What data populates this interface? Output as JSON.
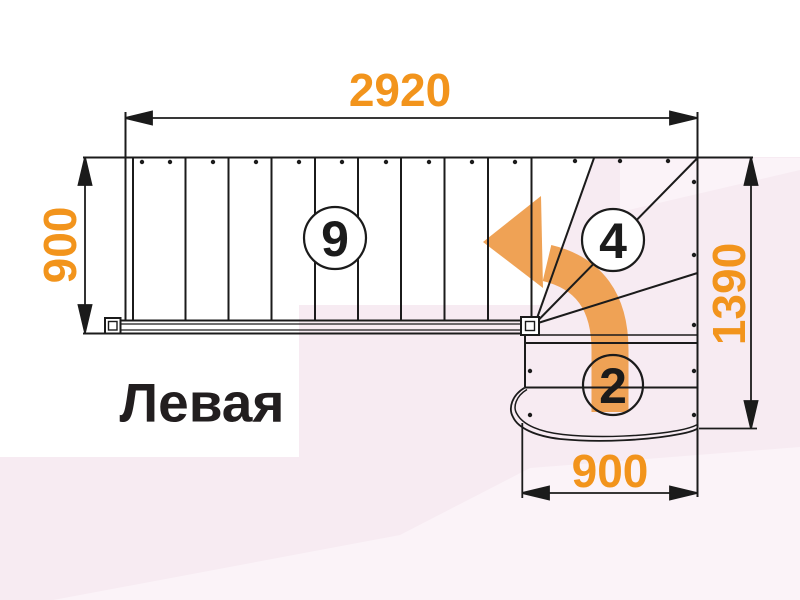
{
  "diagram": {
    "title": "Левая",
    "dimensions": {
      "top": "2920",
      "left": "900",
      "right": "1390",
      "bottom": "900"
    },
    "step_counts": {
      "upper_flight": "9",
      "winder": "4",
      "lower_flight": "2"
    }
  },
  "colors": {
    "dimension_orange": "#f2941c",
    "arrow_orange": "#efa255",
    "line_black": "#1b1b1b",
    "background_pink": "#f7ebf2",
    "background_pink_light": "#fbf3f8",
    "background_white": "#ffffff"
  }
}
